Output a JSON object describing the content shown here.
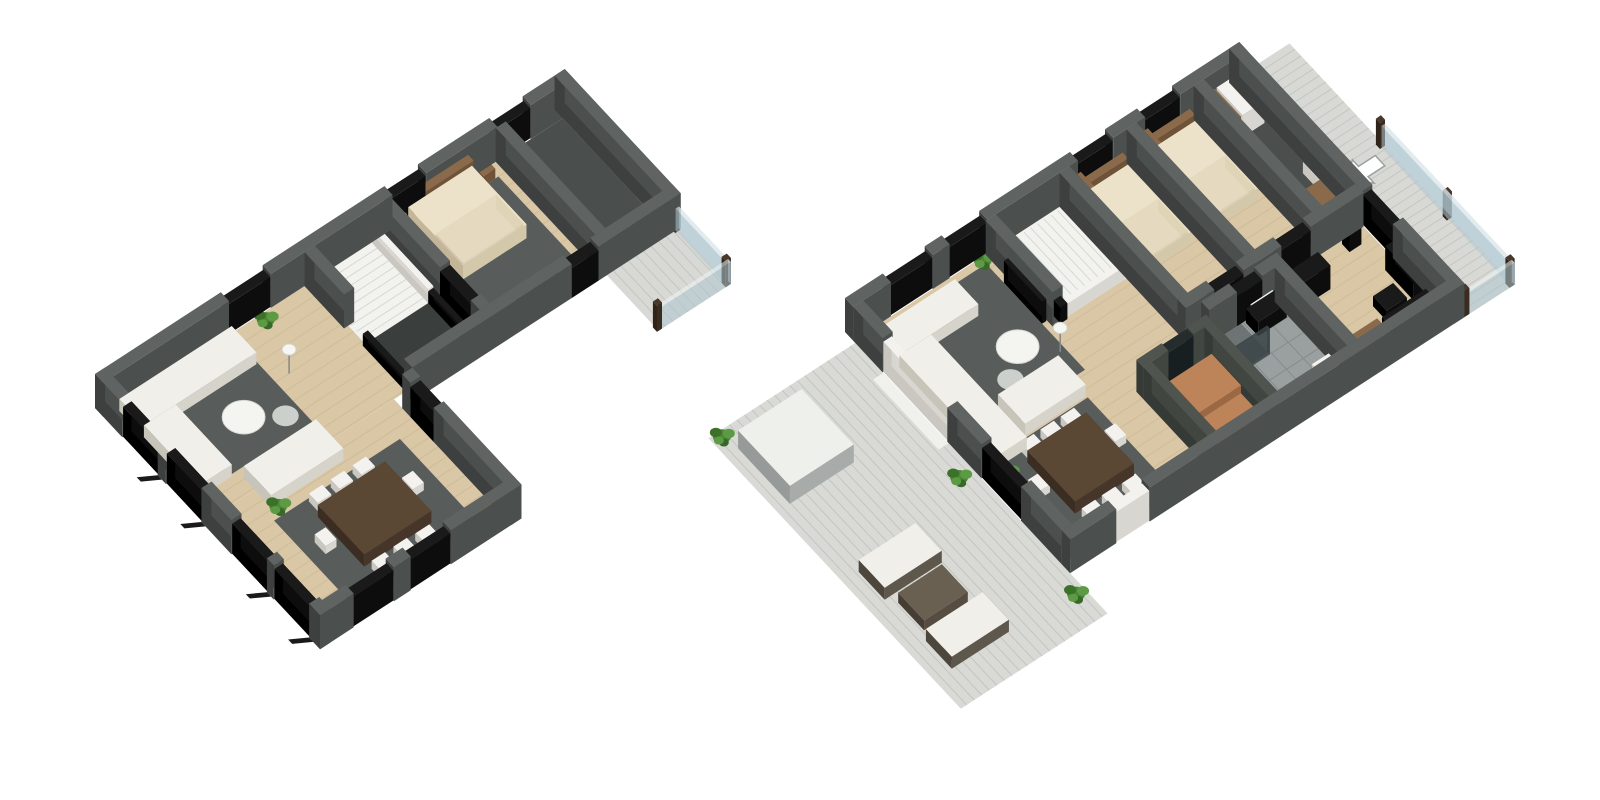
{
  "scene": {
    "kind": "3d-floor-plan-pair",
    "background": "#ffffff"
  },
  "palette": {
    "wall_top": "#5f6361",
    "wall_se": "#4b4f4e",
    "wall_sw": "#3d403f",
    "wood_floor": "#d9c7a6",
    "wood_line": "#c7b28c",
    "dark_floor": "#4a4e4d",
    "void_floor": "#3a3e3d",
    "rug": "#585d5c",
    "patio_stone": "#d9dad6",
    "patio_line": "#c3c5c0",
    "deck_board": "#d8d9d5",
    "deck_line": "#c4c6c1",
    "stair_white": "#f2f2ef",
    "stair_line": "#d8d8d3",
    "sofa_top": "#f1efe9",
    "sofa_se": "#d6d3cb",
    "sofa_sw": "#c7c4ba",
    "pillow_top": "#8c2e4a",
    "pillow_se": "#6e2239",
    "pillow_sw": "#5e1d30",
    "linen_top": "#ece2ca",
    "linen_se": "#d4c8aa",
    "linen_sw": "#c4b698",
    "linen_shade": "#e2d6b8",
    "brown_top": "#8a6a4b",
    "brown_se": "#6f5339",
    "brown_sw": "#5d4530",
    "sauna_top": "#bd8459",
    "sauna_se": "#9c6743",
    "sauna_sw": "#8a5938",
    "sauna_slat": "#a06b45",
    "black_top": "#1a1a1a",
    "black_se": "#0d0d0d",
    "black_sw": "#000000",
    "white_top": "#f3f2ee",
    "white_se": "#d8d6d0",
    "white_sw": "#c9c7c0",
    "tile": "#9aa0a0",
    "tile_line": "#868c8c",
    "tile_dark": "#6e7474",
    "glass": "#aec7cf",
    "glass_edge": "#eef4f5",
    "post_brown": "#4a382a",
    "hot_tub_water": "#98d3c0",
    "hot_tub_rim_top": "#eef0ec",
    "hot_tub_rim_se": "#a7aba9",
    "hot_tub_rim_sw": "#969a98",
    "table_dark_top": "#5a4734",
    "table_dark_se": "#46362a",
    "table_dark_sw": "#3b2d22",
    "outdoor_frame_se": "#5e574c",
    "outdoor_frame_sw": "#4c463d",
    "coffee_top": "#6a6052",
    "coffee_se": "#564c42",
    "coffee_sw": "#463d34",
    "plant_a": "#4d8838",
    "plant_b": "#3c712a",
    "plant_c": "#5c9a44",
    "plant_d": "#38672a",
    "flower_red": "#b03040",
    "flower_yellow": "#e0a62c",
    "arrow_fill": "#ffffff",
    "arrow_stroke": "#9ba1a0",
    "lamp_white": "#f6f6f2",
    "gray_table": "#ccd0cc",
    "washer_dot": "#c9cbc8",
    "radiator_tick": "#c8cac7",
    "shower_glass": "#3a4446"
  },
  "plans": {
    "upper": {
      "name": "upper-floor-plan",
      "position": "left",
      "rooms": [
        {
          "name": "living-room",
          "items": [
            "sectional-sofa",
            "red-pillows",
            "round-coffee-tables",
            "loveseat",
            "floor-lamp",
            "potted-plant"
          ]
        },
        {
          "name": "dining-area",
          "items": [
            "dining-table",
            "white-chairs",
            "flower-centerpiece",
            "area-rug",
            "open-casement-windows"
          ]
        },
        {
          "name": "stair-hall",
          "items": [
            "staircase",
            "white-balustrade",
            "black-stair-rail"
          ]
        },
        {
          "name": "bedroom",
          "items": [
            "double-bed",
            "nightstands",
            "table-lamps",
            "area-rug",
            "foot-bench",
            "tv-panel"
          ]
        },
        {
          "name": "terrace-room",
          "items": []
        },
        {
          "name": "balcony",
          "items": [
            "glass-railing",
            "deck-boards",
            "balcony-door"
          ]
        }
      ]
    },
    "ground": {
      "name": "ground-floor-plan",
      "position": "right",
      "rooms": [
        {
          "name": "patio",
          "items": [
            "hot-tub",
            "outdoor-sofas",
            "outdoor-coffee-table",
            "potted-plants",
            "stone-paving"
          ]
        },
        {
          "name": "living-room",
          "items": [
            "sectional-sofa",
            "red-pillows",
            "round-coffee-tables",
            "loveseat",
            "floor-lamp",
            "tv-panel"
          ]
        },
        {
          "name": "dining-area",
          "items": [
            "dining-table",
            "white-chairs",
            "flower-centerpiece",
            "area-rug"
          ]
        },
        {
          "name": "staircase",
          "items": [
            "white-stairs",
            "balustrade"
          ]
        },
        {
          "name": "bedroom-1",
          "items": [
            "bed",
            "wardrobe",
            "tv-panel"
          ]
        },
        {
          "name": "bedroom-2",
          "items": [
            "bed",
            "wardrobe",
            "tv-panel"
          ]
        },
        {
          "name": "utility-room",
          "items": [
            "washer",
            "cabinets",
            "radiator"
          ]
        },
        {
          "name": "sauna",
          "items": [
            "wood-benches",
            "glass-door"
          ]
        },
        {
          "name": "bathroom",
          "items": [
            "shower",
            "vanity-sink",
            "toilet",
            "tile-floor"
          ]
        },
        {
          "name": "office-nook",
          "items": [
            "desk",
            "desk-chair",
            "cabinet"
          ]
        },
        {
          "name": "entry-deck",
          "items": [
            "entrance-arrow",
            "glass-railing",
            "deck-boards",
            "console"
          ]
        }
      ]
    }
  }
}
